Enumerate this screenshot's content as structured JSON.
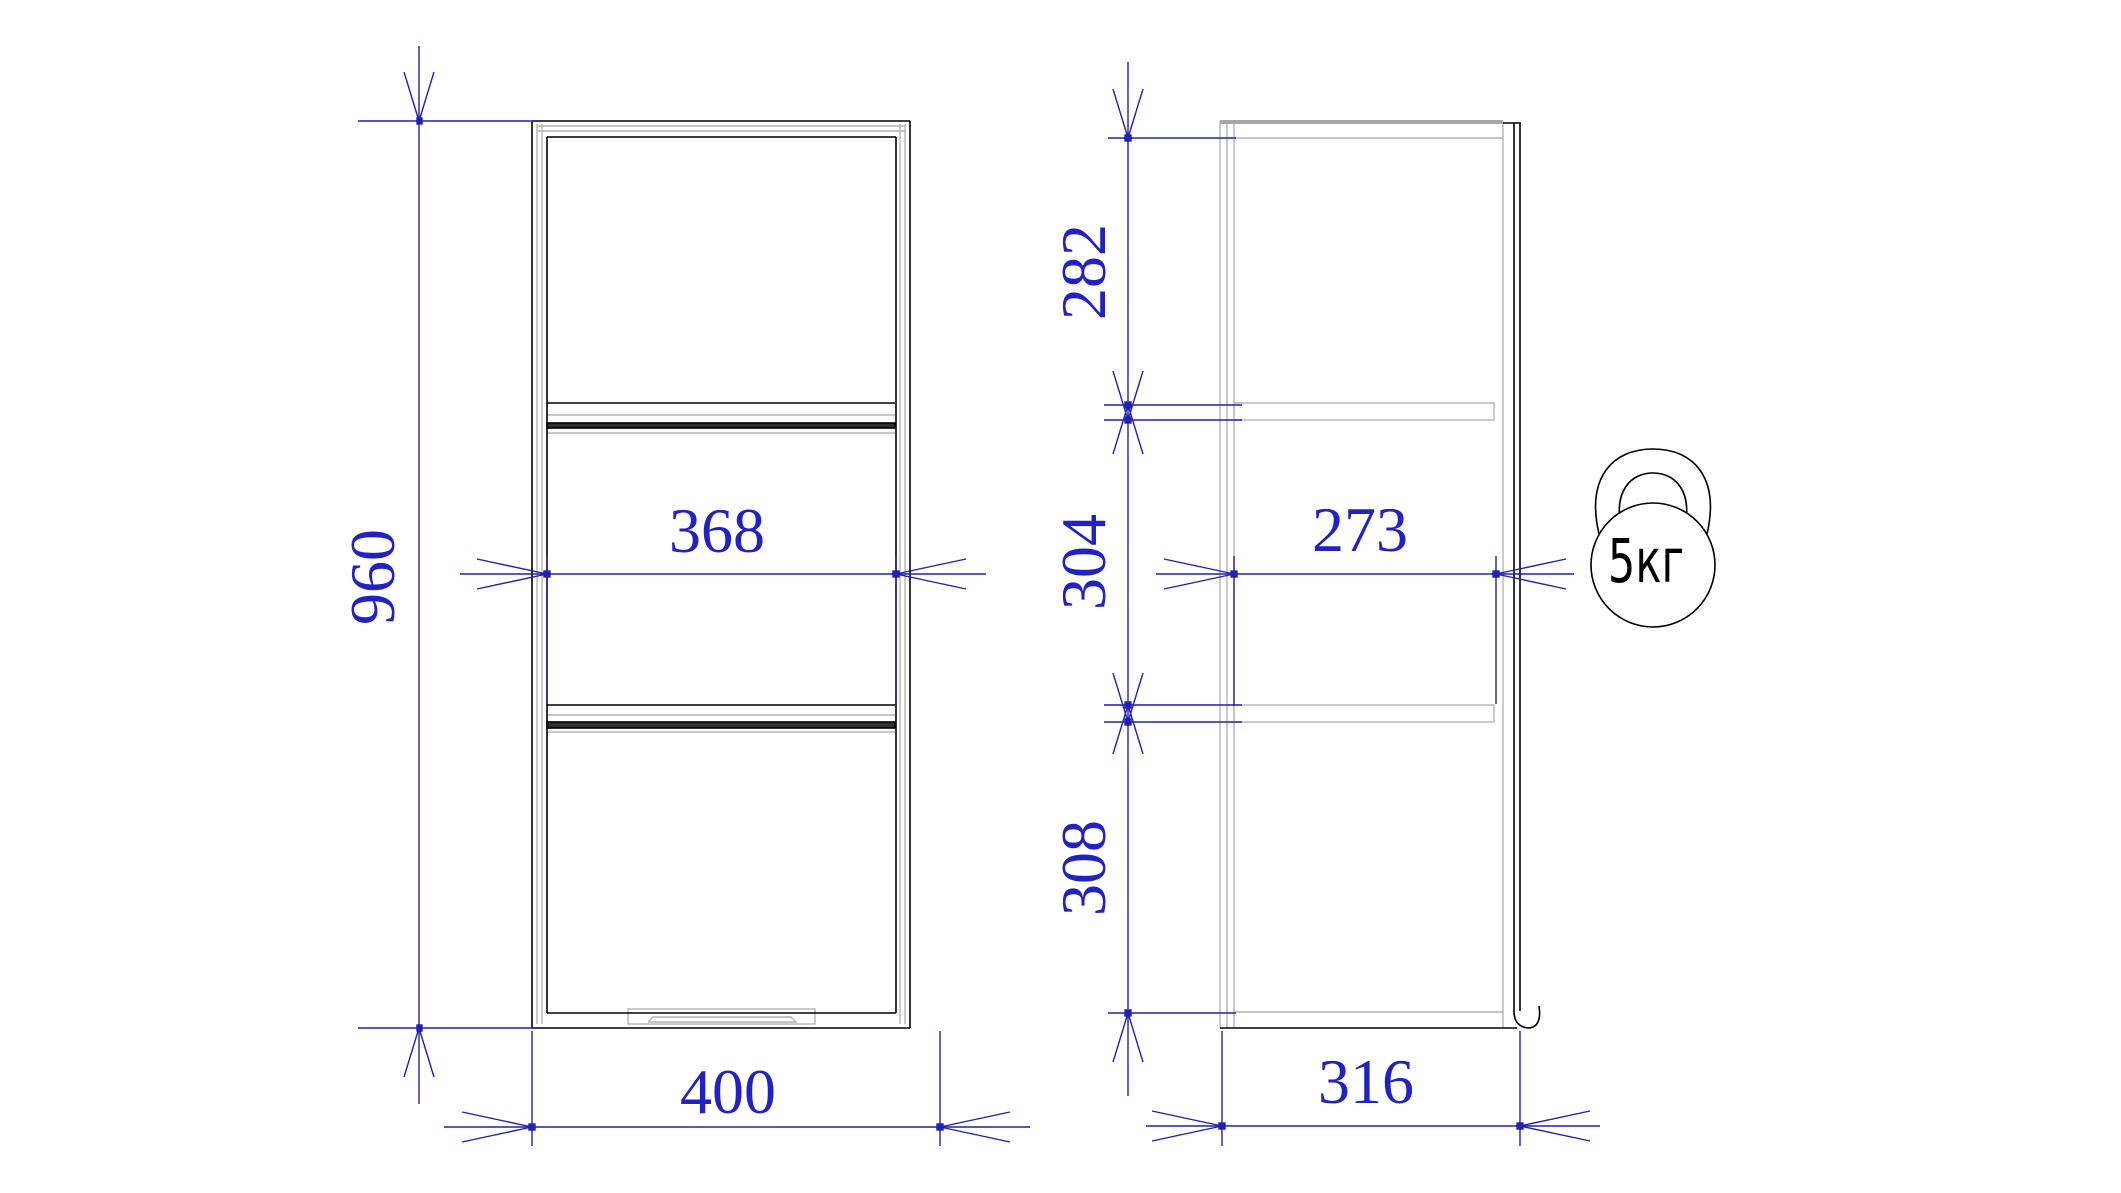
{
  "drawing": {
    "title": "cabinet-dimension-drawing",
    "front_view": {
      "dimensions": {
        "overall_height": "960",
        "inner_width": "368",
        "overall_width": "400"
      }
    },
    "side_view": {
      "dimensions": {
        "top_compartment": "282",
        "middle_compartment": "304",
        "bottom_compartment": "308",
        "inner_depth": "273",
        "overall_depth": "316"
      }
    },
    "load_capacity": {
      "label": "5кг"
    },
    "colors": {
      "dimension_blue": "#2121b0",
      "outline_black": "#000000",
      "panel_gray": "#b4b4b4"
    }
  }
}
